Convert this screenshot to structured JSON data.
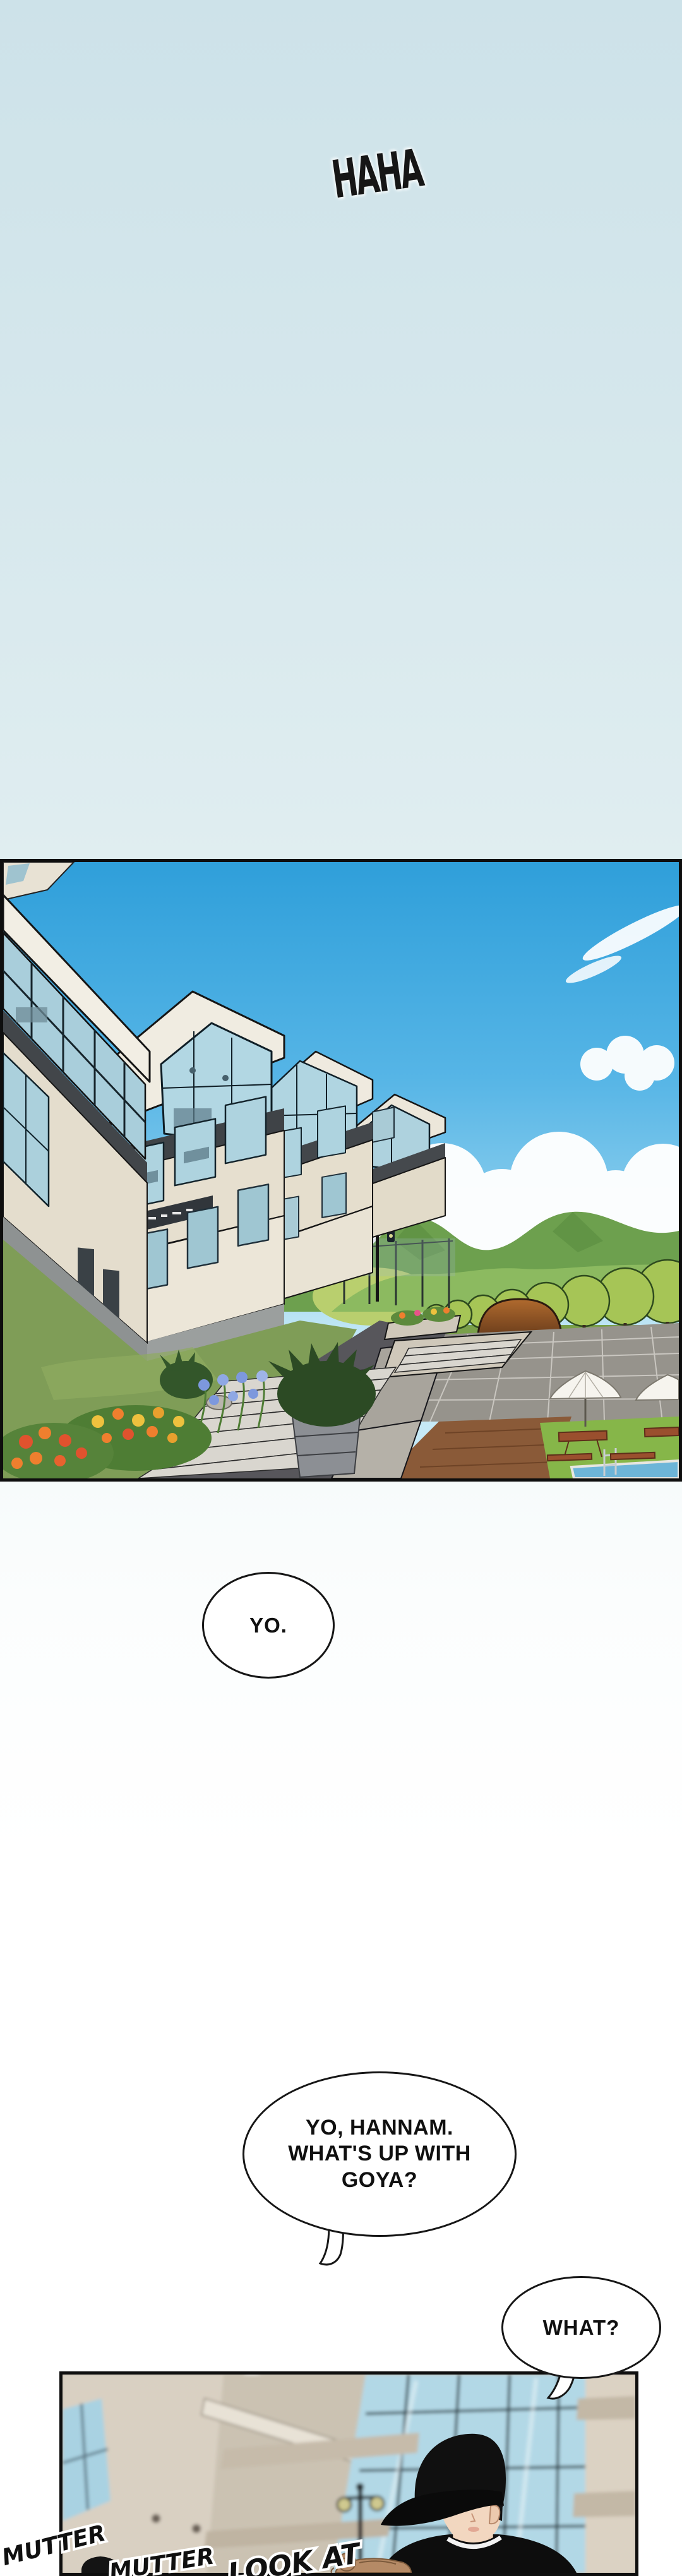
{
  "sfx": {
    "haha": "HAHA",
    "mutter_1": "MUTTER",
    "mutter_2": "MUTTER",
    "look_at": "LOOK AT"
  },
  "speech": {
    "yo": "YO.",
    "hannam": [
      "YO, HANNAM.",
      "WHAT'S UP WITH",
      "GOYA?"
    ],
    "what": "WHAT?"
  },
  "colors": {
    "page_top": "#cde2e9",
    "page_bottom": "#ffffff",
    "panel_border": "#0e0e0e",
    "sky_top": "#2f9fda",
    "sky_bottom": "#c6e9f6",
    "cloud": "#ffffff",
    "mountain_far": "#6da04e",
    "mountain_near": "#8cba60",
    "tree_foliage": "#a6c556",
    "building_wall": "#e6dfcf",
    "building_roof": "#f2eee4",
    "glass_pane": "#aed3df",
    "fascia_dark": "#42464a",
    "lawn": "#7f9d57",
    "walkway_dark": "#57565b",
    "plaza_tile": "#96938c",
    "stair_tread": "#d9d6cf",
    "deck_wood": "#8a5a38",
    "pool_water": "#6db5d8",
    "canopy_bronze": "#a8622f",
    "umbrella_white": "#f6f4ee",
    "flower_orange": "#ef7f2e",
    "flower_yellow": "#eec13e",
    "flower_blue": "#7d98dd",
    "bottom_wall": "#d8cfc1",
    "bottom_glass": "#b2d8e6",
    "cap_black": "#101010",
    "skin": "#f2d7c0",
    "bun_hair": "#b58a66"
  }
}
